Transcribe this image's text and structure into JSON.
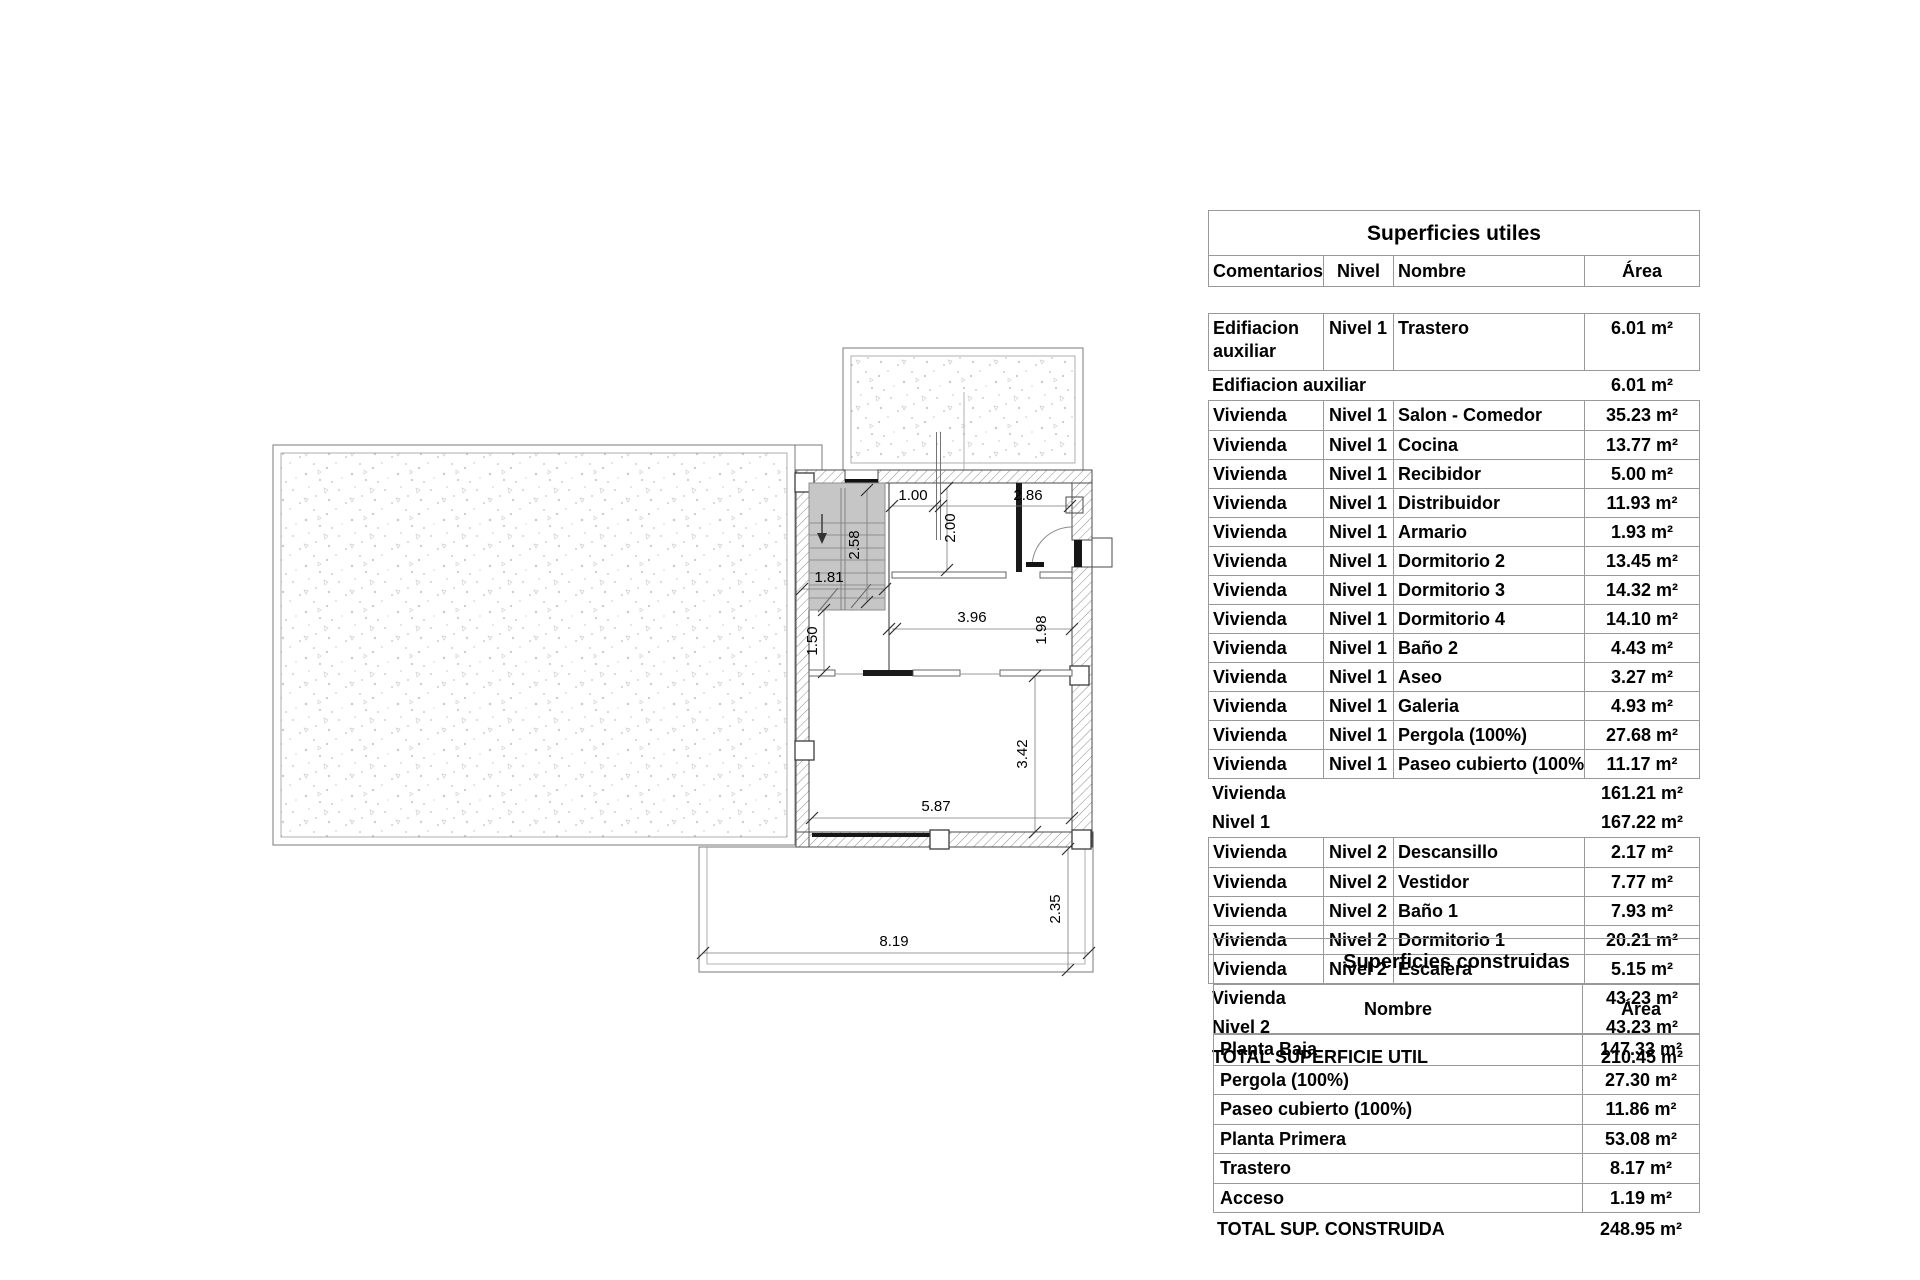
{
  "plan": {
    "dimensions": [
      {
        "name": "dim-1-00",
        "label": "1.00"
      },
      {
        "name": "dim-2-86",
        "label": "2.86"
      },
      {
        "name": "dim-2-00",
        "label": "2.00"
      },
      {
        "name": "dim-2-58",
        "label": "2.58"
      },
      {
        "name": "dim-1-81",
        "label": "1.81"
      },
      {
        "name": "dim-1-50",
        "label": "1.50"
      },
      {
        "name": "dim-3-96",
        "label": "3.96"
      },
      {
        "name": "dim-1-98",
        "label": "1.98"
      },
      {
        "name": "dim-3-42",
        "label": "3.42"
      },
      {
        "name": "dim-5-87",
        "label": "5.87"
      },
      {
        "name": "dim-8-19",
        "label": "8.19"
      },
      {
        "name": "dim-2-35",
        "label": "2.35"
      }
    ]
  },
  "tables": {
    "utiles": {
      "title": "Superficies utiles",
      "headers": {
        "comentarios": "Comentarios",
        "nivel": "Nivel",
        "nombre": "Nombre",
        "area": "Área"
      },
      "first_row": {
        "comentarios": "Edifiacion auxiliar",
        "nivel": "Nivel 1",
        "nombre": "Trastero",
        "area": "6.01 m²"
      },
      "subtotal_edif": {
        "label": "Edifiacion auxiliar",
        "value": "6.01 m²"
      },
      "nivel1_rows": [
        {
          "comentarios": "Vivienda",
          "nivel": "Nivel 1",
          "nombre": "Salon - Comedor",
          "area": "35.23 m²"
        },
        {
          "comentarios": "Vivienda",
          "nivel": "Nivel 1",
          "nombre": "Cocina",
          "area": "13.77 m²"
        },
        {
          "comentarios": "Vivienda",
          "nivel": "Nivel 1",
          "nombre": "Recibidor",
          "area": "5.00 m²"
        },
        {
          "comentarios": "Vivienda",
          "nivel": "Nivel 1",
          "nombre": "Distribuidor",
          "area": "11.93 m²"
        },
        {
          "comentarios": "Vivienda",
          "nivel": "Nivel 1",
          "nombre": "Armario",
          "area": "1.93 m²"
        },
        {
          "comentarios": "Vivienda",
          "nivel": "Nivel 1",
          "nombre": "Dormitorio 2",
          "area": "13.45 m²"
        },
        {
          "comentarios": "Vivienda",
          "nivel": "Nivel 1",
          "nombre": "Dormitorio 3",
          "area": "14.32 m²"
        },
        {
          "comentarios": "Vivienda",
          "nivel": "Nivel 1",
          "nombre": "Dormitorio 4",
          "area": "14.10 m²"
        },
        {
          "comentarios": "Vivienda",
          "nivel": "Nivel 1",
          "nombre": "Baño 2",
          "area": "4.43 m²"
        },
        {
          "comentarios": "Vivienda",
          "nivel": "Nivel 1",
          "nombre": "Aseo",
          "area": "3.27 m²"
        },
        {
          "comentarios": "Vivienda",
          "nivel": "Nivel 1",
          "nombre": "Galeria",
          "area": "4.93 m²"
        },
        {
          "comentarios": "Vivienda",
          "nivel": "Nivel 1",
          "nombre": "Pergola (100%)",
          "area": "27.68 m²"
        },
        {
          "comentarios": "Vivienda",
          "nivel": "Nivel 1",
          "nombre": "Paseo cubierto (100%)",
          "area": "11.17 m²"
        }
      ],
      "subtotal_vivienda1": {
        "label": "Vivienda",
        "value": "161.21 m²"
      },
      "subtotal_nivel1": {
        "label": "Nivel 1",
        "value": "167.22 m²"
      },
      "nivel2_rows": [
        {
          "comentarios": "Vivienda",
          "nivel": "Nivel 2",
          "nombre": "Descansillo",
          "area": "2.17 m²"
        },
        {
          "comentarios": "Vivienda",
          "nivel": "Nivel 2",
          "nombre": "Vestidor",
          "area": "7.77 m²"
        },
        {
          "comentarios": "Vivienda",
          "nivel": "Nivel 2",
          "nombre": "Baño 1",
          "area": "7.93 m²"
        },
        {
          "comentarios": "Vivienda",
          "nivel": "Nivel 2",
          "nombre": "Dormitorio 1",
          "area": "20.21 m²"
        },
        {
          "comentarios": "Vivienda",
          "nivel": "Nivel 2",
          "nombre": "Escalera",
          "area": "5.15 m²"
        }
      ],
      "subtotal_vivienda2": {
        "label": "Vivienda",
        "value": "43.23 m²"
      },
      "subtotal_nivel2": {
        "label": "Nivel 2",
        "value": "43.23 m²"
      },
      "total": {
        "label": "TOTAL SUPERFICIE UTIL",
        "value": "210.45 m²"
      }
    },
    "construidas": {
      "title": "Superficies construidas",
      "headers": {
        "nombre": "Nombre",
        "area": "Área"
      },
      "rows": [
        {
          "nombre": "Planta Baja",
          "area": "147.33 m²"
        },
        {
          "nombre": "Pergola (100%)",
          "area": "27.30 m²"
        },
        {
          "nombre": "Paseo cubierto (100%)",
          "area": "11.86 m²"
        },
        {
          "nombre": "Planta Primera",
          "area": "53.08 m²"
        },
        {
          "nombre": "Trastero",
          "area": "8.17 m²"
        },
        {
          "nombre": "Acceso",
          "area": "1.19 m²"
        }
      ],
      "total": {
        "label": "TOTAL SUP. CONSTRUIDA",
        "value": "248.95 m²"
      }
    }
  }
}
